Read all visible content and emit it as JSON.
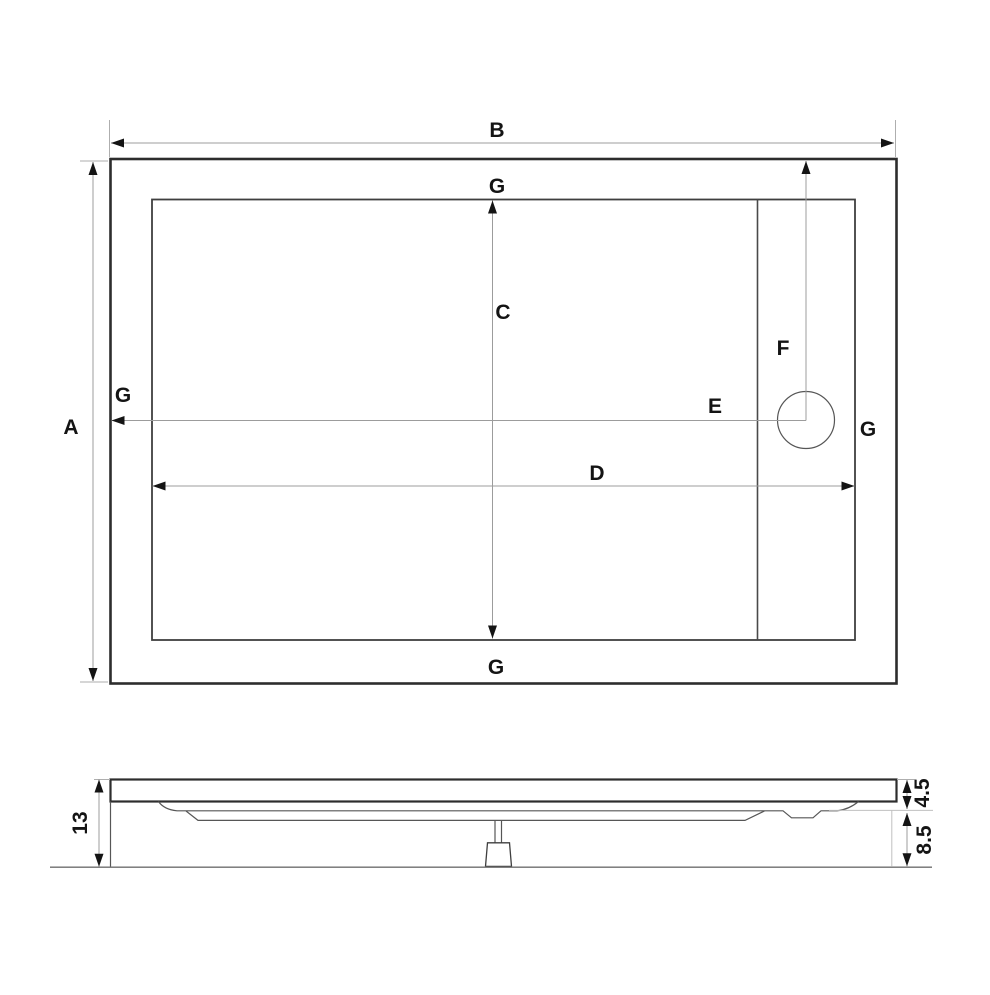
{
  "drawing": {
    "description": "Technical dimension drawing of a rectangular shower tray: plan view with drain and section view",
    "line_color": "#141414",
    "background_color": "#ffffff",
    "plan_view": {
      "dim_overall_width_label": "B",
      "dim_overall_depth_label": "A",
      "dim_inner_depth_label": "C",
      "dim_inner_width_label": "D",
      "dim_drain_from_left_label": "E",
      "dim_drain_from_top_label": "F",
      "rim_label_top": "G",
      "rim_label_left": "G",
      "rim_label_right": "G",
      "rim_label_bottom": "G"
    },
    "section_view": {
      "dim_total_height": "13",
      "dim_rim_height": "4.5",
      "dim_base_height": "8.5"
    }
  }
}
